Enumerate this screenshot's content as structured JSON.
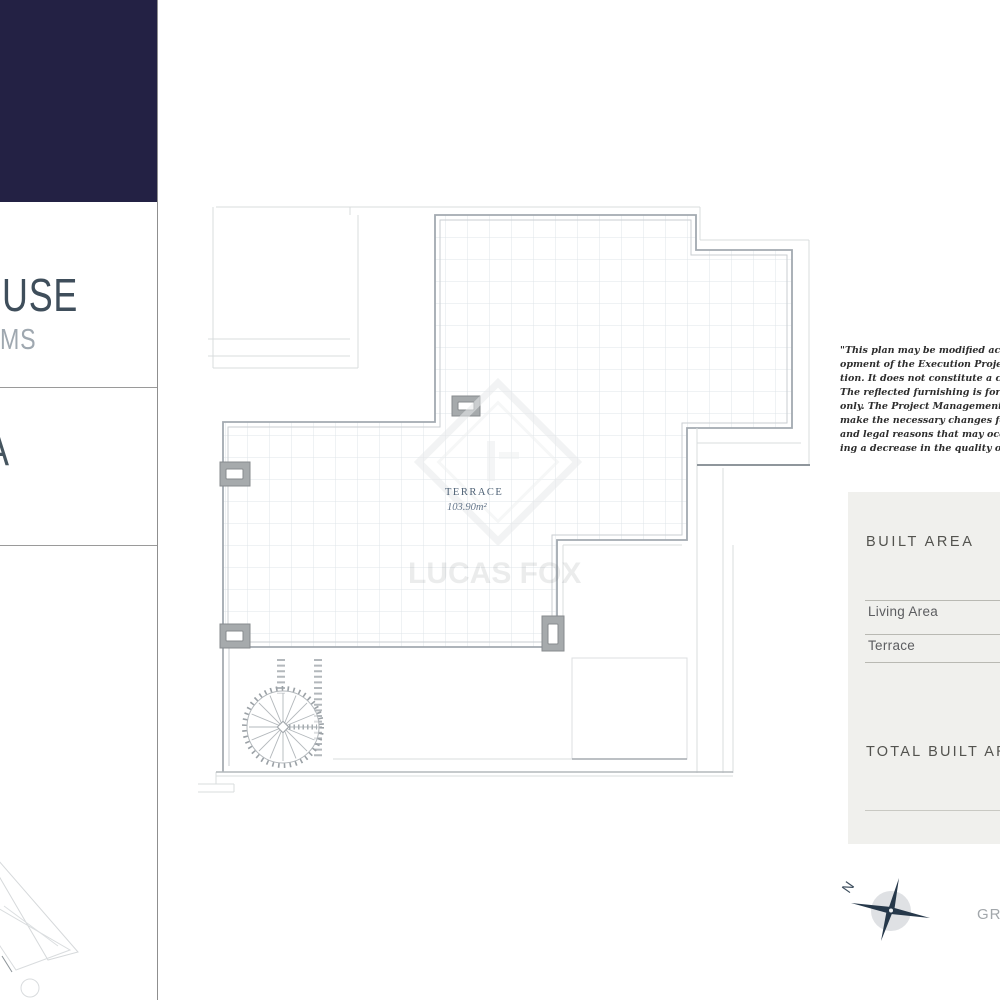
{
  "sidebar": {
    "navy_color": "#232144",
    "title_fragment": "USE",
    "subtitle_fragment": "MS",
    "section_title_fragment": "A"
  },
  "floor_plan": {
    "room_label": "TERRACE",
    "room_area": "103.90m²",
    "watermark_text": "LUCAS FOX"
  },
  "disclaimer_lines": [
    "\"This plan may be modified according",
    "opment of the Execution Project and",
    "tion. It does not constitute a contractu",
    "The reflected furnishing is for decorat",
    "only. The Project Management reser",
    "make the necessary changes for func",
    "and legal reasons that may occur,",
    "ing a decrease in the quality of the"
  ],
  "built_area_card": {
    "title": "BUILT AREA",
    "rows": [
      {
        "label": "Living Area"
      },
      {
        "label": "Terrace"
      }
    ],
    "total_label": "TOTAL BUILT AREA."
  },
  "compass": {
    "north_label": "N"
  },
  "bottom_right_fragment": "GR",
  "colors": {
    "navy": "#232144",
    "wall": "#a2a9b0",
    "grid_line": "#dfe4e8",
    "card_bg": "#f0f0ed",
    "accent_text": "#4e6175",
    "compass_needle": "#26384a"
  }
}
